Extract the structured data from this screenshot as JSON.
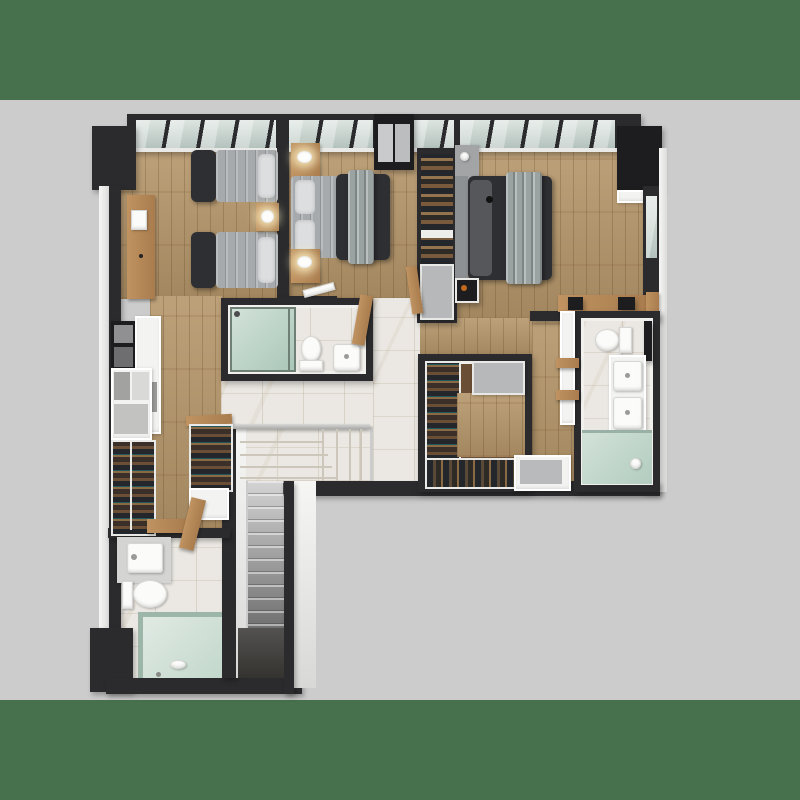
{
  "scene": {
    "description": "Photorealistic top-down 3D architectural render of an L-shaped apartment upper floor plan on a gray backdrop with dark green letterbox bands",
    "view": "top-down dollhouse",
    "text_content": "none"
  },
  "colors": {
    "matte": "#47714d",
    "bg": "#cccccc",
    "wall-dark": "#2b2b2d",
    "wall-black": "#1d1d1f",
    "floor-wood": "#b5966a",
    "marble": "#ebe8e3",
    "glass": "#c9d4d0",
    "cabinet-gray": "#b7b8ba",
    "bed-dark": "#2e2f33",
    "bed-gray": "#a7aaad",
    "clothes-dark": "#23262a",
    "accent-orange": "#c2691f"
  },
  "rooms": [
    {
      "id": "bedroom-1",
      "position": "top-left",
      "items": [
        "twin bed",
        "twin bed",
        "nightstand with lamp",
        "wall shelf with art",
        "window wall"
      ]
    },
    {
      "id": "bedroom-2",
      "position": "top-center",
      "items": [
        "double bed",
        "two nightstands with lamps",
        "open wardrobe column",
        "window wall"
      ]
    },
    {
      "id": "bedroom-3",
      "position": "top-right",
      "items": [
        "double bed with gray throw",
        "headboard shelf with kettle",
        "black corner closet",
        "wood console with bags",
        "window wall"
      ]
    },
    {
      "id": "bathroom-center",
      "items": [
        "glass shower",
        "toilet",
        "sink"
      ]
    },
    {
      "id": "bathroom-right",
      "items": [
        "toilet",
        "double-sink vanity",
        "shower with drain",
        "wood shelves",
        "tall cabinet"
      ]
    },
    {
      "id": "bathroom-lower-left",
      "items": [
        "counter sink",
        "toilet",
        "glass shower"
      ]
    },
    {
      "id": "walk-in-closet",
      "items": [
        "hanging rail",
        "shoe row",
        "two gray cabinets"
      ]
    },
    {
      "id": "closet-hall",
      "items": [
        "two wardrobes with clothes",
        "upper cabinets",
        "wood bench",
        "leaning wood panels"
      ]
    },
    {
      "id": "staircase",
      "items": [
        "railing",
        "winder steps",
        "straight flight",
        "dark lower landing"
      ]
    },
    {
      "id": "hallway",
      "items": [
        "marble tile floor",
        "wood strip floors"
      ]
    }
  ]
}
